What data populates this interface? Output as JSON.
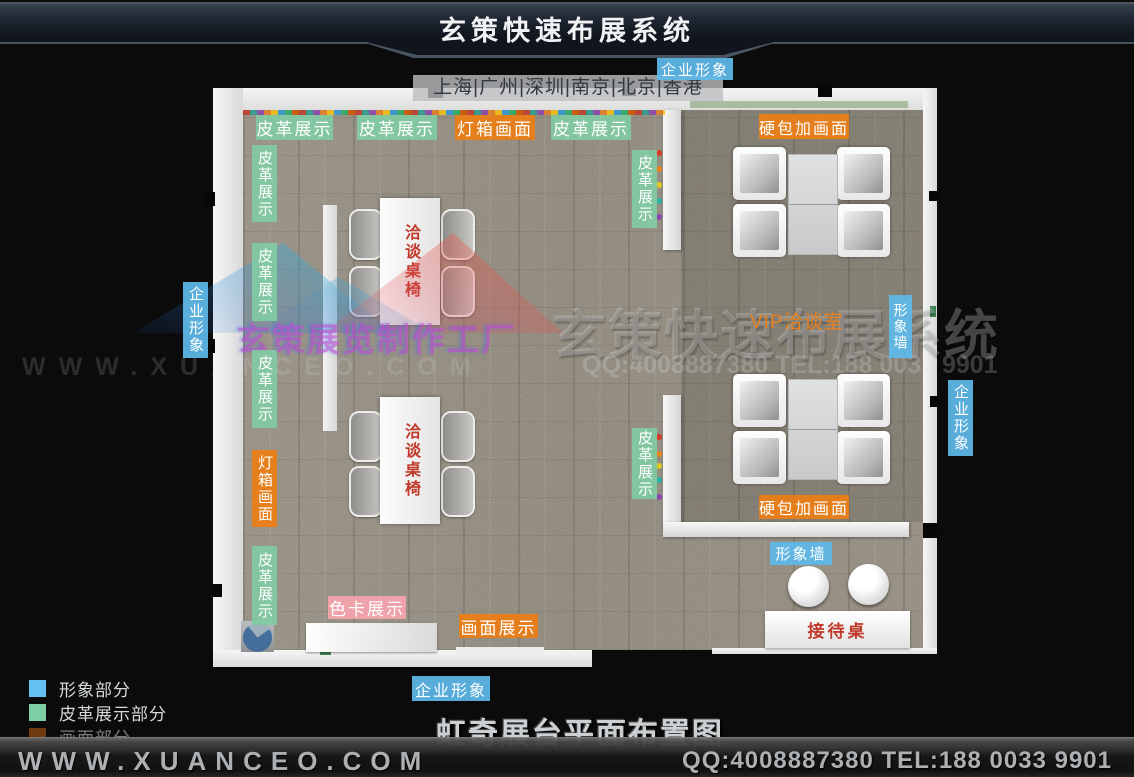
{
  "header": {
    "title": "玄策快速布展系统",
    "corporate_tag": "企业形象",
    "cities": "上海|广州|深圳|南京|北京|香港"
  },
  "watermark": {
    "brand": "玄策快速布展系统",
    "contact": "QQ:4008887380 TEL:188 0033 9901",
    "site": "WWW.XUANCEO.COM",
    "factory": "玄策展览制作工厂"
  },
  "plan": {
    "labels": [
      {
        "id": "leather-top-1",
        "text": "皮革展示"
      },
      {
        "id": "leather-top-2",
        "text": "皮革展示"
      },
      {
        "id": "lightbox-top",
        "text": "灯箱画面"
      },
      {
        "id": "leather-top-3",
        "text": "皮革展示"
      },
      {
        "id": "leather-left-1",
        "text": "皮革展示"
      },
      {
        "id": "leather-left-2",
        "text": "皮革展示"
      },
      {
        "id": "leather-left-3",
        "text": "皮革展示"
      },
      {
        "id": "lightbox-left",
        "text": "灯箱画面"
      },
      {
        "id": "leather-left-4",
        "text": "皮革展示"
      },
      {
        "id": "leather-mid-1",
        "text": "皮革展示"
      },
      {
        "id": "leather-mid-2",
        "text": "皮革展示"
      },
      {
        "id": "corporate-left",
        "text": "企业形象"
      },
      {
        "id": "corporate-right",
        "text": "企业形象"
      },
      {
        "id": "image-wall-v",
        "text": "形象墙"
      },
      {
        "id": "hardpack-top",
        "text": "硬包加画面"
      },
      {
        "id": "hardpack-bottom",
        "text": "硬包加画面"
      },
      {
        "id": "image-wall-h",
        "text": "形象墙"
      },
      {
        "id": "colorcard-display",
        "text": "色卡展示"
      },
      {
        "id": "picture-display",
        "text": "画面展示"
      },
      {
        "id": "corporate-top",
        "text": "企业形象"
      },
      {
        "id": "corporate-bottom",
        "text": "企业形象"
      }
    ],
    "vip_label": "VIP洽谈室",
    "table_label": "洽谈桌椅",
    "reception_label": "接待桌"
  },
  "legend": {
    "items": [
      {
        "label": "形象部分",
        "swatch": "#62c1ee"
      },
      {
        "label": "皮革展示部分",
        "swatch": "#7ecfa4"
      },
      {
        "label": "画面部分",
        "swatch": "#c06012"
      },
      {
        "label": "色卡展示",
        "swatch": "#d48a94"
      }
    ]
  },
  "caption": "虹奇展台平面布置图",
  "footer": {
    "site": "WWW.XUANCEO.COM",
    "contact": "QQ:4008887380 TEL:188 0033 9901"
  },
  "colors": {
    "blue": "#5fb9e9",
    "green": "#81caa2",
    "orange": "#e97e17",
    "pink": "#f3a3ab",
    "red_text": "#c23a2b"
  }
}
